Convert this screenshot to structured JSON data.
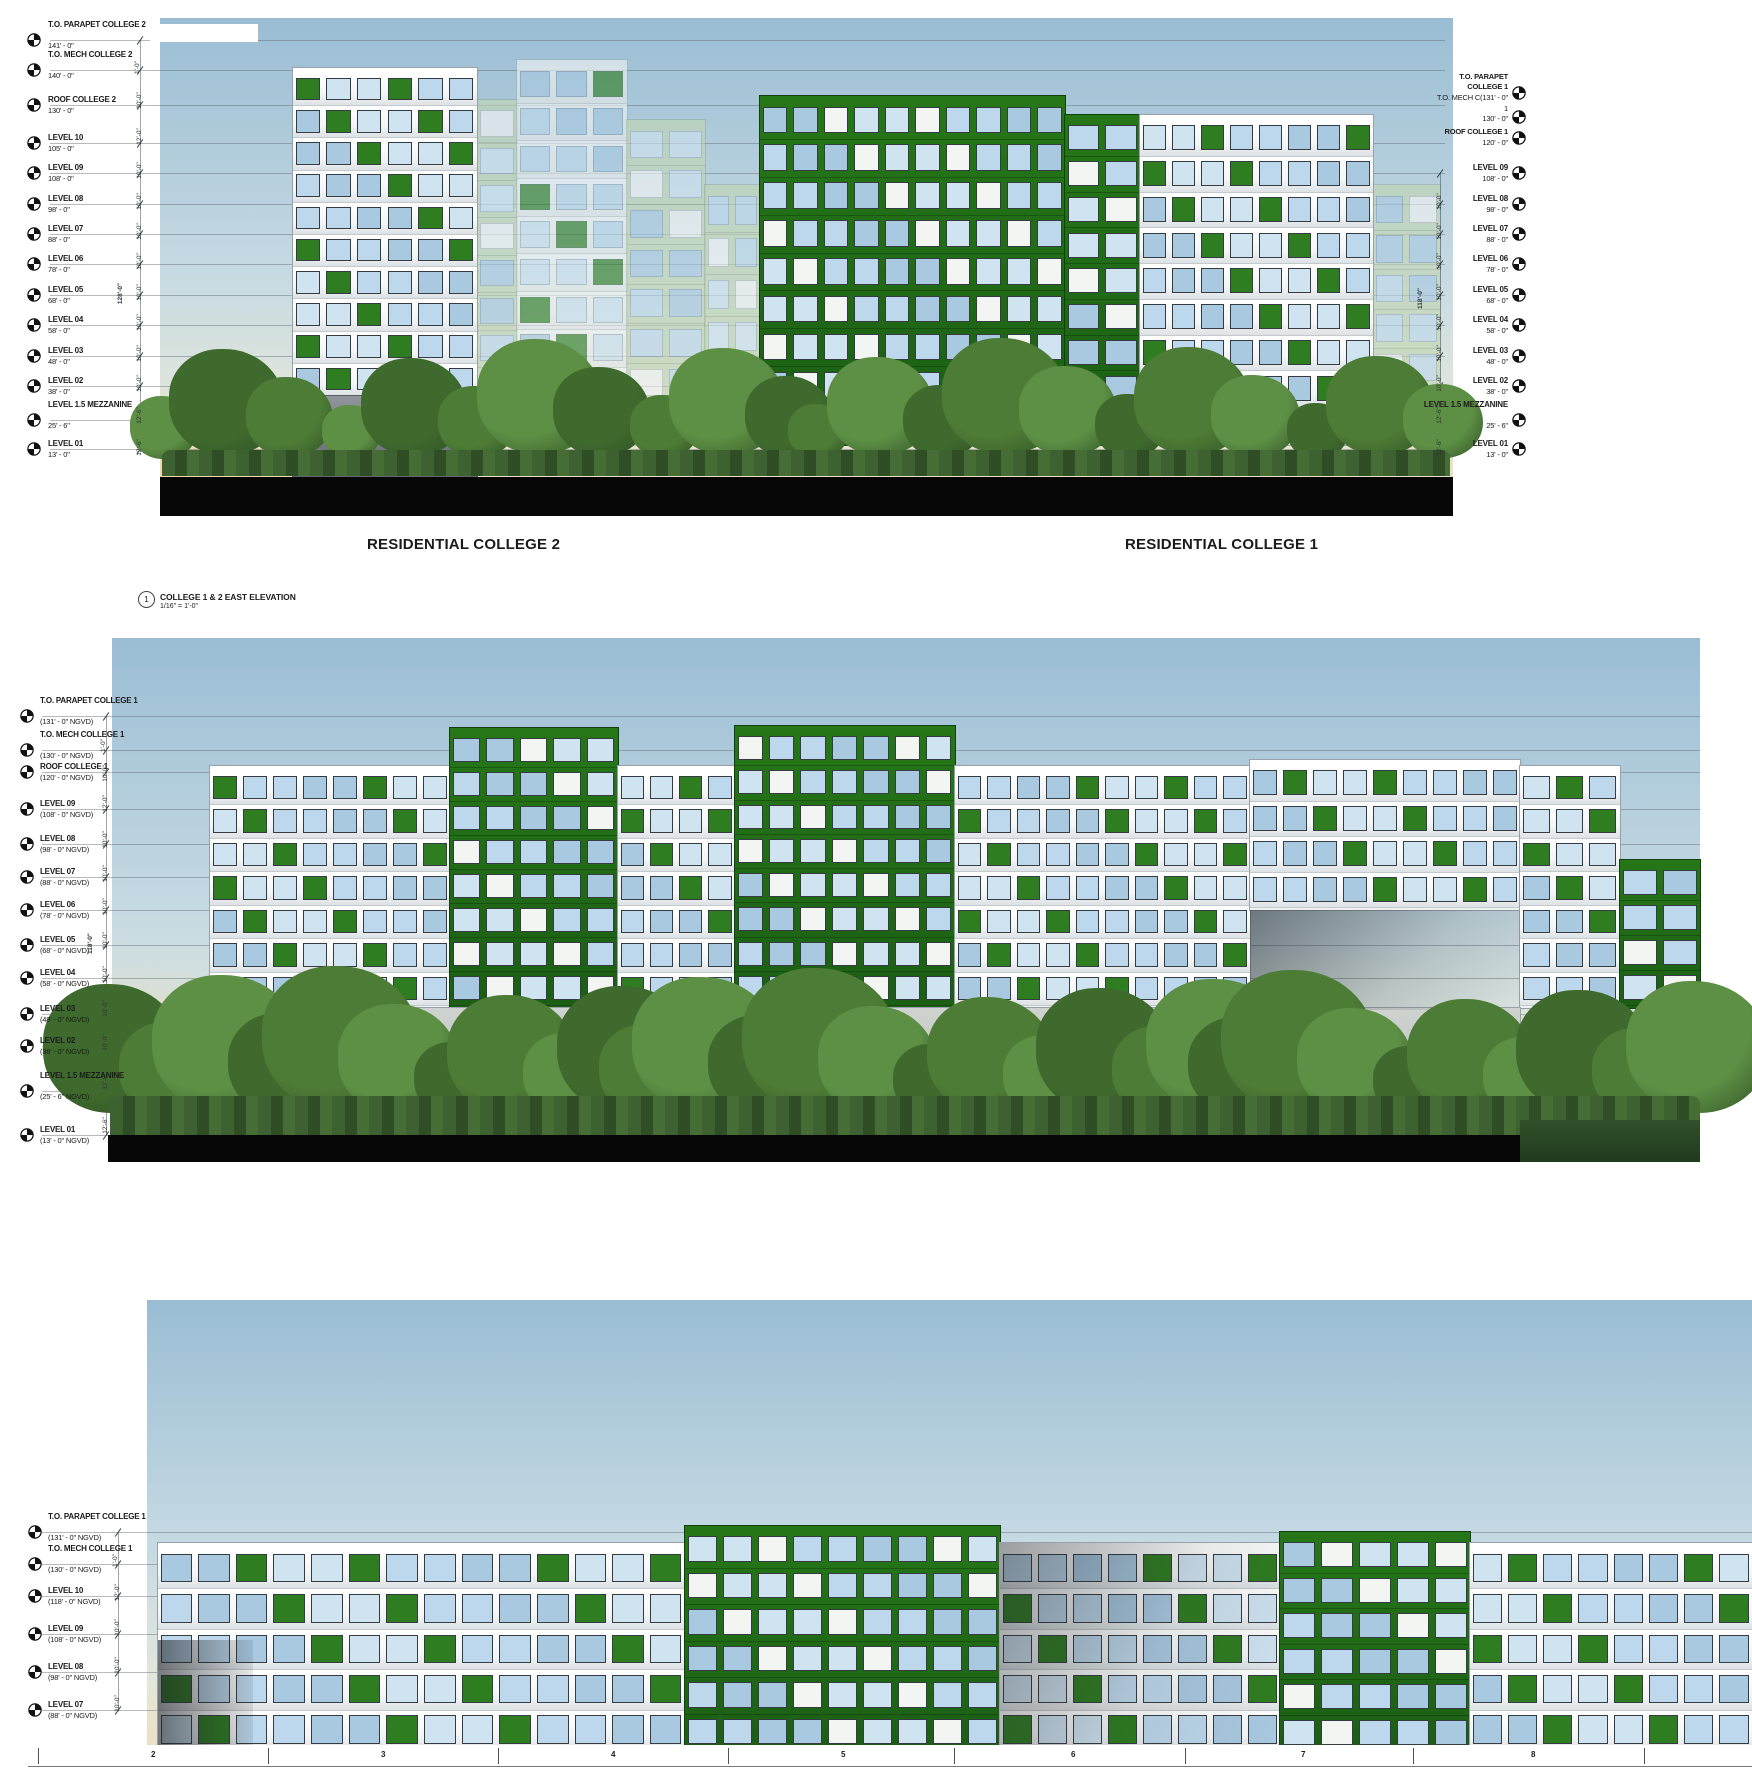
{
  "colors": {
    "sky_top": "#9abdd4",
    "sky_mid": "#c6dae3",
    "sky_low": "#e3e7db",
    "sky_warm": "#eddfc4",
    "facade_white": "#f7f8f7",
    "facade_green": "#1d6a1d",
    "accent_green": "#2e7d20",
    "glass_light": "#cfe3f1",
    "glass_mid": "#bdd8ec",
    "glass_dark": "#a9c9e1",
    "ghost_green": "#c2d6b2",
    "ground_black": "#070707",
    "tree_green": "#4d7c36",
    "line_gray": "#5f6973"
  },
  "view_title": {
    "number": "1",
    "title": "COLLEGE 1 & 2 EAST ELEVATION",
    "scale": "1/16\" = 1'-0\""
  },
  "top_elevation": {
    "captions": {
      "college_2": "RESIDENTIAL COLLEGE 2",
      "college_1": "RESIDENTIAL COLLEGE 1"
    },
    "left_levels": [
      {
        "label": "T.O. PARAPET COLLEGE 2",
        "value": "141' - 0\""
      },
      {
        "label": "T.O. MECH COLLEGE 2",
        "value": "140' - 0\""
      },
      {
        "label": "ROOF COLLEGE 2",
        "value": "130' - 0\""
      },
      {
        "label": "LEVEL 10",
        "value": "105' - 0\""
      },
      {
        "label": "LEVEL 09",
        "value": "108' - 0\""
      },
      {
        "label": "LEVEL 08",
        "value": "98' - 0\""
      },
      {
        "label": "LEVEL 07",
        "value": "88' - 0\""
      },
      {
        "label": "LEVEL 06",
        "value": "78' - 0\""
      },
      {
        "label": "LEVEL 05",
        "value": "68' - 0\""
      },
      {
        "label": "LEVEL 04",
        "value": "58' - 0\""
      },
      {
        "label": "LEVEL 03",
        "value": "48' - 0\""
      },
      {
        "label": "LEVEL 02",
        "value": "38' - 0\""
      },
      {
        "label": "LEVEL 1.5 MEZZANINE",
        "value": "25' - 6\""
      },
      {
        "label": "LEVEL 01",
        "value": "13' - 0\""
      }
    ],
    "right_header_lines": [
      "T.O. PARAPET",
      "COLLEGE 1",
      "T.O. MECH C(131' - 0\"",
      "1",
      "130' - 0\"",
      "ROOF COLLEGE 1",
      "120' - 0\""
    ],
    "right_levels": [
      {
        "label": "LEVEL 09",
        "value": "108' - 0\""
      },
      {
        "label": "LEVEL 08",
        "value": "98' - 0\""
      },
      {
        "label": "LEVEL 07",
        "value": "88' - 0\""
      },
      {
        "label": "LEVEL 06",
        "value": "78' - 0\""
      },
      {
        "label": "LEVEL 05",
        "value": "68' - 0\""
      },
      {
        "label": "LEVEL 04",
        "value": "58' - 0\""
      },
      {
        "label": "LEVEL 03",
        "value": "48' - 0\""
      },
      {
        "label": "LEVEL 02",
        "value": "38' - 0\""
      },
      {
        "label": "LEVEL 1.5 MEZZANINE",
        "value": "25' - 6\""
      },
      {
        "label": "LEVEL 01",
        "value": "13' - 0\""
      }
    ],
    "dim_total_left": "128'-0\"",
    "dim_total_right": "118'-0\"",
    "gaps_left": [
      "1'-0\"",
      "10'-0\"",
      "12'-0\"",
      "10'-0\"",
      "10'-0\"",
      "10'-0\"",
      "10'-0\"",
      "10'-0\"",
      "10'-0\"",
      "10'-0\"",
      "10'-0\"",
      "12'-6\"",
      "12'-6\""
    ],
    "gaps_right": [
      "10'-0\"",
      "10'-0\"",
      "10'-0\"",
      "10'-0\"",
      "10'-0\"",
      "10'-0\"",
      "10'-0\"",
      "12'-6\"",
      "12'-6\""
    ]
  },
  "middle_elevation": {
    "levels": [
      {
        "label": "T.O. PARAPET COLLEGE 1",
        "value": "(131' - 0\" NGVD)"
      },
      {
        "label": "T.O. MECH COLLEGE 1",
        "value": "(130' - 0\" NGVD)"
      },
      {
        "label": "ROOF COLLEGE 1",
        "value": "(120' - 0\" NGVD)"
      },
      {
        "label": "LEVEL 09",
        "value": "(108' - 0\" NGVD)"
      },
      {
        "label": "LEVEL 08",
        "value": "(98' - 0\" NGVD)"
      },
      {
        "label": "LEVEL 07",
        "value": "(88' - 0\" NGVD)"
      },
      {
        "label": "LEVEL 06",
        "value": "(78' - 0\" NGVD)"
      },
      {
        "label": "LEVEL 05",
        "value": "(68' - 0\" NGVD)"
      },
      {
        "label": "LEVEL 04",
        "value": "(58' - 0\" NGVD)"
      },
      {
        "label": "LEVEL 03",
        "value": "(48' - 0\" NGVD)"
      },
      {
        "label": "LEVEL 02",
        "value": "(38' - 0\" NGVD)"
      },
      {
        "label": "LEVEL 1.5 MEZZANINE",
        "value": "(25' - 6\" NGVD)"
      },
      {
        "label": "LEVEL 01",
        "value": "(13' - 0\" NGVD)"
      }
    ],
    "dim_total": "118'-0\"",
    "gaps": [
      "1'-0\"",
      "10'-0\"",
      "12'-0\"",
      "10'-0\"",
      "10'-0\"",
      "10'-0\"",
      "10'-0\"",
      "10'-0\"",
      "10'-0\"",
      "10'-0\"",
      "12'-6\"",
      "12'-6\""
    ]
  },
  "bottom_elevation": {
    "levels": [
      {
        "label": "T.O. PARAPET COLLEGE 1",
        "value": "(131' - 0\" NGVD)"
      },
      {
        "label": "T.O. MECH COLLEGE 1",
        "value": "(130' - 0\" NGVD)"
      },
      {
        "label": "LEVEL 10",
        "value": "(118' - 0\" NGVD)"
      },
      {
        "label": "LEVEL 09",
        "value": "(108' - 0\" NGVD)"
      },
      {
        "label": "LEVEL 08",
        "value": "(98' - 0\" NGVD)"
      },
      {
        "label": "LEVEL 07",
        "value": "(88' - 0\" NGVD)"
      }
    ],
    "gaps": [
      "1'-0\"",
      "12'-0\"",
      "10'-0\"",
      "10'-0\"",
      "10'-0\""
    ],
    "grid_numbers": [
      "2",
      "3",
      "4",
      "5",
      "6",
      "7",
      "8"
    ]
  }
}
